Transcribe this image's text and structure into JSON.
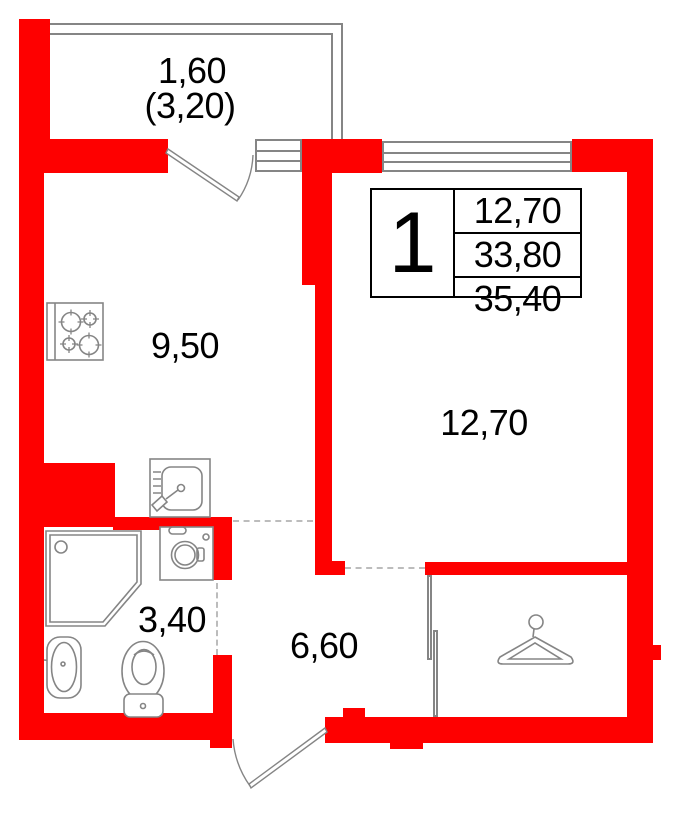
{
  "title": "Apartment floor plan, 1 room",
  "colors": {
    "wall_red": "#fe0000",
    "fixture_gray": "#858585",
    "dash_gray": "#bcbcbc",
    "text_black": "#000000"
  },
  "rooms": {
    "balcony": {
      "name": "balcony",
      "area_reduced": "1,60",
      "area_full_bracketed": "(3,20)"
    },
    "kitchen": {
      "name": "kitchen",
      "area": "9,50"
    },
    "living_room": {
      "name": "living-room",
      "area": "12,70"
    },
    "bathroom": {
      "name": "bathroom",
      "area": "3,40"
    },
    "hallway": {
      "name": "hallway",
      "area": "6,60"
    }
  },
  "info_box": {
    "rooms_count": "1",
    "rows": [
      "12,70",
      "33,80",
      "35,40"
    ]
  },
  "icons": {
    "stove": "stove-icon (4 burners)",
    "kitchen_sink": "kitchen-sink-icon",
    "washing_machine": "washing-machine-icon",
    "shower": "shower-cabin-icon",
    "washbasin": "washbasin-icon",
    "toilet": "toilet-icon",
    "hanger": "clothes-hanger-icon (wardrobe)",
    "balcony_door": "door-swing-arc",
    "entrance_door": "door-swing-arc"
  }
}
